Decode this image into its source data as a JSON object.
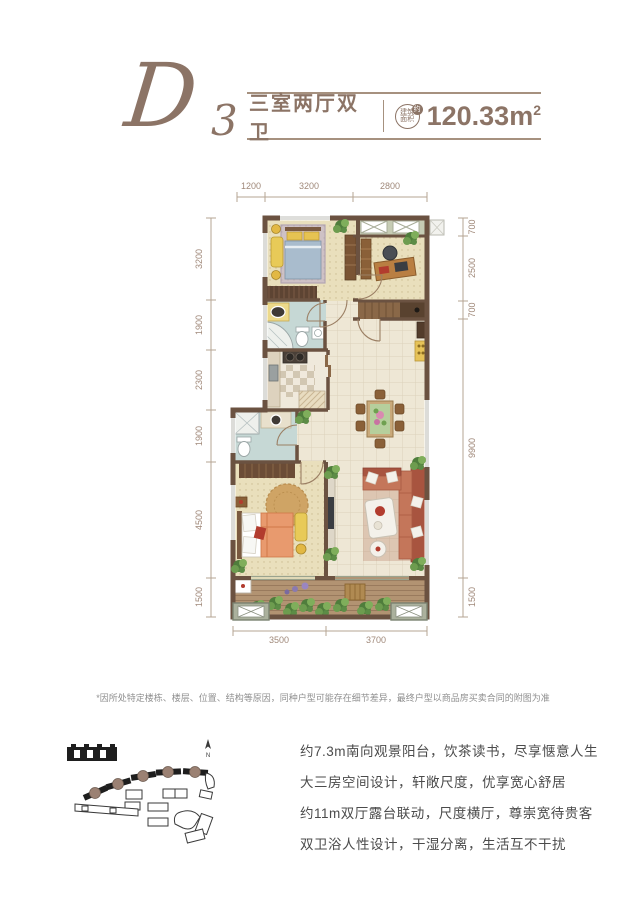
{
  "header": {
    "plan_code": "D",
    "plan_code_sub": "3",
    "layout_label": "三室两厅双卫",
    "badge": {
      "line1": "建筑",
      "line2": "面积",
      "mark": "约"
    },
    "area_value": "120.33",
    "area_unit": "m",
    "area_sup": "2"
  },
  "dims": {
    "top": [
      "1200",
      "3200",
      "2800"
    ],
    "left": [
      "3200",
      "1900",
      "2300",
      "1900",
      "4500",
      "1500"
    ],
    "right": [
      "700",
      "2500",
      "700",
      "9900",
      "1500"
    ],
    "bottom": [
      "3500",
      "3700"
    ]
  },
  "disclaimer": "*因所处特定楼栋、楼层、位置、结构等原因，同种户型可能存在细节差异，最终户型以商品房买卖合同的附图为准",
  "site_plan": {
    "north_label": "N"
  },
  "features": [
    "约7.3m南向观景阳台，饮茶读书，尽享惬意人生",
    "大三房空间设计，轩敞尺度，优享宽心舒居",
    "约11m双厅露台联动，尺度横厅，尊崇宽待贵客",
    "双卫浴人性设计，干湿分离，生活互不干扰"
  ],
  "colors": {
    "accent_brown": "#8c7466",
    "rule": "#a6917f",
    "dim_text": "#a0897a",
    "wall": "#6b5241",
    "body_text": "#4b4b4b",
    "disclaimer_text": "#8f8f8f",
    "marker_brown": "#9b8173"
  }
}
